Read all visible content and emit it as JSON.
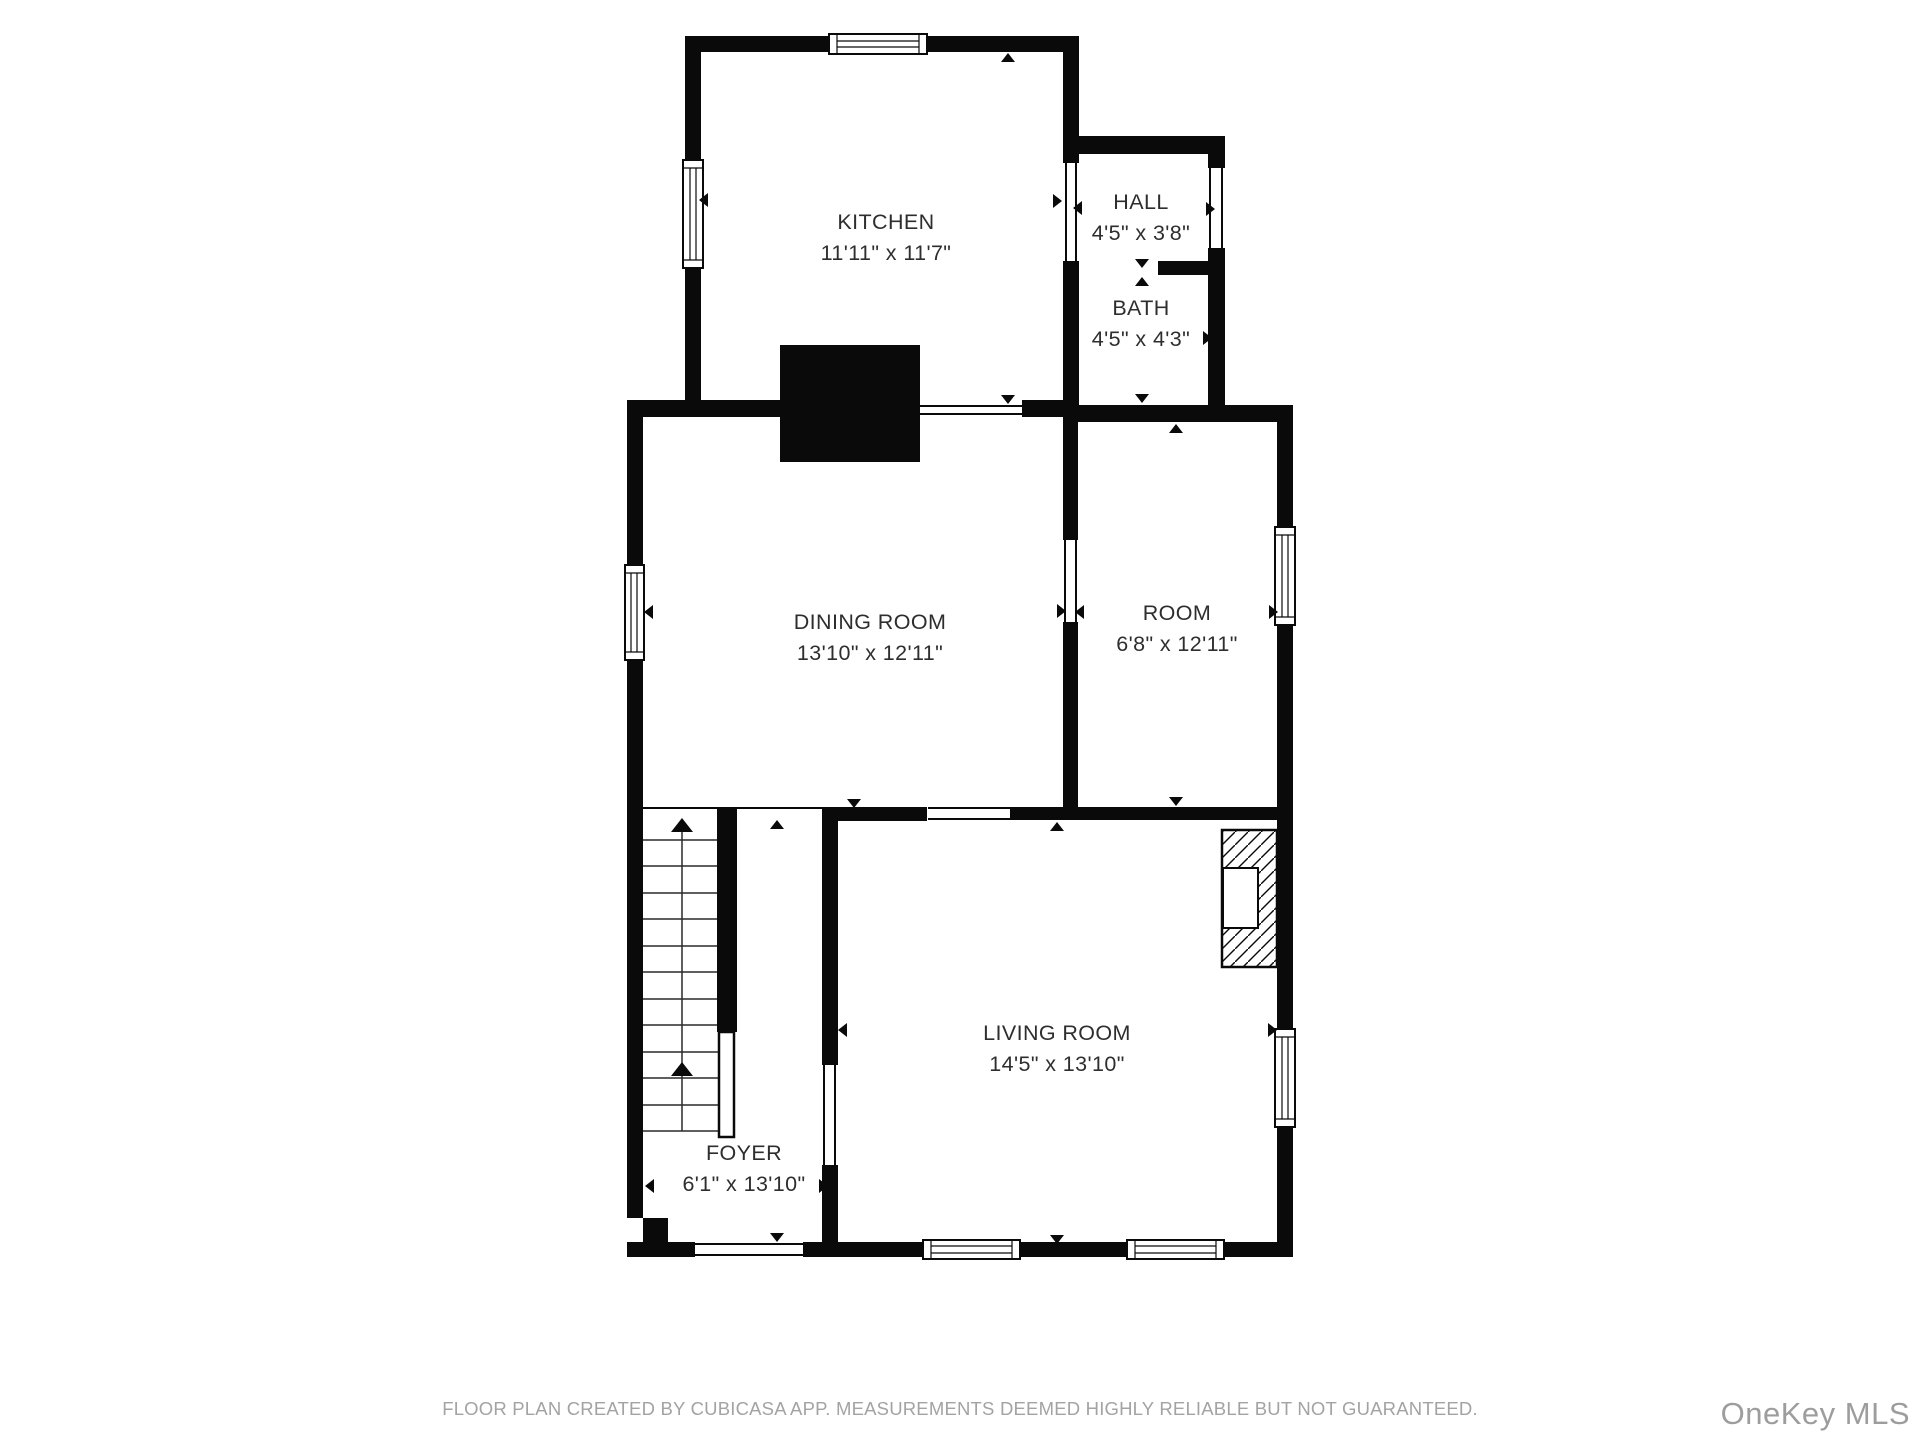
{
  "plan": {
    "rooms": [
      {
        "id": "kitchen",
        "name": "KITCHEN",
        "dimensions": "11'11\" x 11'7\""
      },
      {
        "id": "hall",
        "name": "HALL",
        "dimensions": "4'5\" x 3'8\""
      },
      {
        "id": "bath",
        "name": "BATH",
        "dimensions": "4'5\" x 4'3\""
      },
      {
        "id": "dining-room",
        "name": "DINING ROOM",
        "dimensions": "13'10\" x 12'11\""
      },
      {
        "id": "room",
        "name": "ROOM",
        "dimensions": "6'8\" x 12'11\""
      },
      {
        "id": "living-room",
        "name": "LIVING ROOM",
        "dimensions": "14'5\" x 13'10\""
      },
      {
        "id": "foyer",
        "name": "FOYER",
        "dimensions": "6'1\" x 13'10\""
      }
    ],
    "features": [
      "staircase",
      "fireplace",
      "chimney"
    ],
    "colors": {
      "background": "#ffffff",
      "wall": "#0a0a0a",
      "room_text": "#2e2e2e",
      "footer_text": "#a3a3a3",
      "watermark_text": "#9d9d9d"
    }
  },
  "footer": {
    "disclaimer": "FLOOR PLAN CREATED BY CUBICASA APP. MEASUREMENTS DEEMED HIGHLY RELIABLE BUT NOT GUARANTEED."
  },
  "watermark": {
    "text": "OneKey MLS"
  }
}
